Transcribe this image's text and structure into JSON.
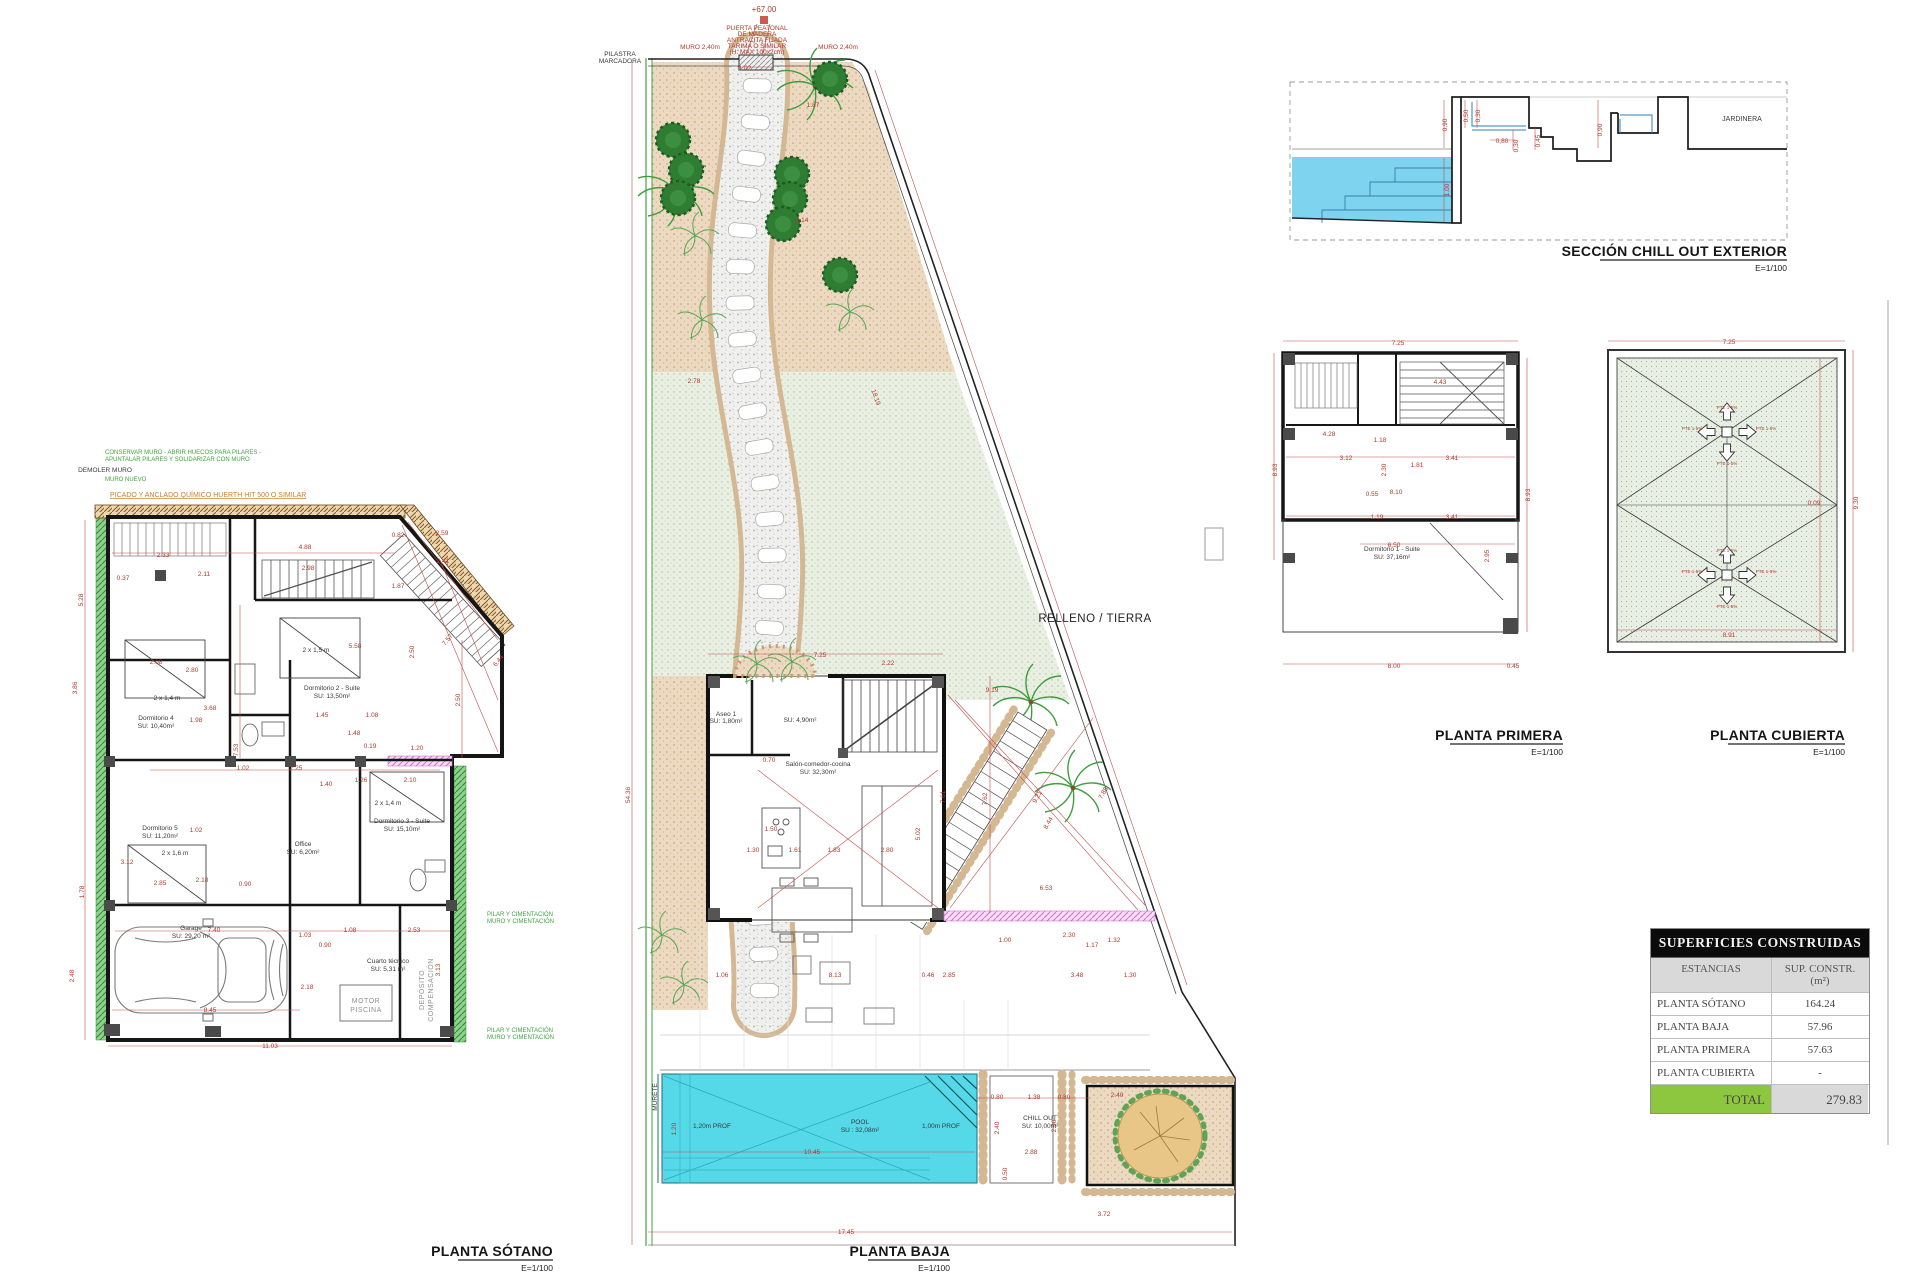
{
  "titles": {
    "sotano": "PLANTA SÓTANO",
    "baja": "PLANTA BAJA",
    "primera": "PLANTA PRIMERA",
    "cubierta": "PLANTA CUBIERTA",
    "seccion": "SECCIÓN CHILL OUT EXTERIOR",
    "scale": "E=1/100"
  },
  "sotano": {
    "annotations": [
      {
        "x": 105,
        "y": 454,
        "t": "CONSERVAR MURO - ABRIR HUECOS PARA PILARES -",
        "c": "g"
      },
      {
        "x": 105,
        "y": 461,
        "t": "APUNTALAR PILARES Y SOLIDARIZAR CON MURO",
        "c": "g"
      },
      {
        "x": 105,
        "y": 472,
        "t": "DEMOLER MURO",
        "c": "k"
      },
      {
        "x": 105,
        "y": 481,
        "t": "MURO NUEVO",
        "c": "g"
      },
      {
        "x": 110,
        "y": 497,
        "t": "PICADO Y ANCLADO QUÍMICO HUERTH HIT 500 O SIMILAR",
        "c": "o"
      },
      {
        "x": 487,
        "y": 916,
        "t": "PILAR Y CIMENTACIÓN",
        "c": "g"
      },
      {
        "x": 487,
        "y": 923,
        "t": "MURO Y CIMENTACIÓN",
        "c": "g"
      },
      {
        "x": 487,
        "y": 1032,
        "t": "PILAR Y CIMENTACIÓN",
        "c": "g"
      },
      {
        "x": 487,
        "y": 1039,
        "t": "MURO Y CIMENTACIÓN",
        "c": "g"
      }
    ],
    "labels": [
      {
        "x": 167,
        "y": 700,
        "t": "2 x 1,4 m"
      },
      {
        "x": 156,
        "y": 720,
        "t": "Dormitorio 4"
      },
      {
        "x": 156,
        "y": 728,
        "t": "SU: 10,40m²"
      },
      {
        "x": 332,
        "y": 690,
        "t": "Dormitorio 2 - Suite"
      },
      {
        "x": 332,
        "y": 698,
        "t": "SU: 13,50m²"
      },
      {
        "x": 316,
        "y": 652,
        "t": "2 x 1,5 m"
      },
      {
        "x": 160,
        "y": 830,
        "t": "Dormitorio 5"
      },
      {
        "x": 160,
        "y": 838,
        "t": "SU: 11,20m²"
      },
      {
        "x": 175,
        "y": 855,
        "t": "2 x 1,6 m"
      },
      {
        "x": 303,
        "y": 846,
        "t": "Office"
      },
      {
        "x": 303,
        "y": 854,
        "t": "SU: 6,20m²"
      },
      {
        "x": 402,
        "y": 823,
        "t": "Dormitorio 3 - Suite"
      },
      {
        "x": 402,
        "y": 831,
        "t": "SU: 15,10m²"
      },
      {
        "x": 388,
        "y": 805,
        "t": "2 x 1,4 m"
      },
      {
        "x": 191,
        "y": 930,
        "t": "Garage"
      },
      {
        "x": 191,
        "y": 938,
        "t": "SU: 29,20 m²"
      },
      {
        "x": 388,
        "y": 963,
        "t": "Cuarto técnico"
      },
      {
        "x": 388,
        "y": 971,
        "t": "SU: 5,31 m²"
      },
      {
        "x": 366,
        "y": 1003,
        "t": "MOTOR",
        "c": "y"
      },
      {
        "x": 366,
        "y": 1012,
        "t": "PISCINA",
        "c": "y"
      },
      {
        "x": 424,
        "y": 990,
        "t": "DEPÓSITO",
        "c": "y",
        "r": -90
      },
      {
        "x": 433,
        "y": 990,
        "t": "COMPENSACIÓN",
        "c": "y",
        "r": -90
      }
    ],
    "dims": [
      {
        "x": 163,
        "y": 557,
        "t": "2.33"
      },
      {
        "x": 123,
        "y": 580,
        "t": "0.37"
      },
      {
        "x": 204,
        "y": 576,
        "t": "2.11"
      },
      {
        "x": 83,
        "y": 600,
        "t": "5.28",
        "r": -90
      },
      {
        "x": 305,
        "y": 549,
        "t": "4.88"
      },
      {
        "x": 308,
        "y": 570,
        "t": "2.98"
      },
      {
        "x": 398,
        "y": 588,
        "t": "1.87"
      },
      {
        "x": 443,
        "y": 563,
        "t": "2.41"
      },
      {
        "x": 449,
        "y": 641,
        "t": "7.57",
        "r": -50
      },
      {
        "x": 414,
        "y": 652,
        "t": "2.50",
        "r": -90
      },
      {
        "x": 355,
        "y": 648,
        "t": "5.58"
      },
      {
        "x": 77,
        "y": 688,
        "t": "3.86",
        "r": -90
      },
      {
        "x": 156,
        "y": 664,
        "t": "2.08"
      },
      {
        "x": 192,
        "y": 672,
        "t": "2.80"
      },
      {
        "x": 210,
        "y": 710,
        "t": "3.68"
      },
      {
        "x": 196,
        "y": 722,
        "t": "1.98"
      },
      {
        "x": 238,
        "y": 750,
        "t": "7.53",
        "r": -90
      },
      {
        "x": 243,
        "y": 770,
        "t": "1.02"
      },
      {
        "x": 296,
        "y": 770,
        "t": "2.25"
      },
      {
        "x": 322,
        "y": 717,
        "t": "1.45"
      },
      {
        "x": 372,
        "y": 717,
        "t": "1.08"
      },
      {
        "x": 354,
        "y": 735,
        "t": "1.48"
      },
      {
        "x": 370,
        "y": 748,
        "t": "0.19"
      },
      {
        "x": 326,
        "y": 786,
        "t": "1.40"
      },
      {
        "x": 361,
        "y": 782,
        "t": "1.26"
      },
      {
        "x": 410,
        "y": 782,
        "t": "2.10"
      },
      {
        "x": 196,
        "y": 832,
        "t": "1.02"
      },
      {
        "x": 127,
        "y": 864,
        "t": "3.12"
      },
      {
        "x": 84,
        "y": 892,
        "t": "1.78",
        "r": -90
      },
      {
        "x": 74,
        "y": 976,
        "t": "2.48",
        "r": -90
      },
      {
        "x": 160,
        "y": 885,
        "t": "2.85"
      },
      {
        "x": 202,
        "y": 882,
        "t": "2.18"
      },
      {
        "x": 245,
        "y": 886,
        "t": "0.90"
      },
      {
        "x": 214,
        "y": 932,
        "t": "7.40"
      },
      {
        "x": 305,
        "y": 937,
        "t": "1.03"
      },
      {
        "x": 350,
        "y": 932,
        "t": "1.08"
      },
      {
        "x": 414,
        "y": 932,
        "t": "2.53"
      },
      {
        "x": 325,
        "y": 947,
        "t": "0.90"
      },
      {
        "x": 307,
        "y": 989,
        "t": "2.18"
      },
      {
        "x": 210,
        "y": 1012,
        "t": "8.45"
      },
      {
        "x": 270,
        "y": 1048,
        "t": "11.03"
      },
      {
        "x": 440,
        "y": 970,
        "t": "3.13",
        "r": -90
      },
      {
        "x": 398,
        "y": 537,
        "t": "0.82"
      },
      {
        "x": 442,
        "y": 535,
        "t": "2.59"
      },
      {
        "x": 500,
        "y": 662,
        "t": "6.44",
        "r": -50
      },
      {
        "x": 417,
        "y": 750,
        "t": "1.20"
      },
      {
        "x": 460,
        "y": 700,
        "t": "2.50",
        "r": -90
      }
    ]
  },
  "baja": {
    "level": "+67.00",
    "relleno": "RELLENO / TIERRA",
    "labels": [
      {
        "x": 757,
        "y": 30,
        "t": "PUERTA PEATONAL",
        "c": "d"
      },
      {
        "x": 757,
        "y": 36,
        "t": "DE MADERA",
        "c": "d"
      },
      {
        "x": 757,
        "y": 42,
        "t": "ANTRACITA FIJADA",
        "c": "d"
      },
      {
        "x": 757,
        "y": 48,
        "t": "TARIMA O SIMILAR",
        "c": "d"
      },
      {
        "x": 757,
        "y": 54,
        "t": "(H. MAX 100x2cm)",
        "c": "d"
      },
      {
        "x": 620,
        "y": 56,
        "t": "PILASTRA"
      },
      {
        "x": 620,
        "y": 63,
        "t": "MARCADORA"
      },
      {
        "x": 726,
        "y": 716,
        "t": "Aseo 1"
      },
      {
        "x": 726,
        "y": 723,
        "t": "SU: 1,80m²"
      },
      {
        "x": 800,
        "y": 722,
        "t": "SU: 4,90m²"
      },
      {
        "x": 818,
        "y": 766,
        "t": "Salón-comedor-cocina"
      },
      {
        "x": 818,
        "y": 774,
        "t": "SU: 32,30m²"
      },
      {
        "x": 712,
        "y": 1128,
        "t": "1,20m PROF"
      },
      {
        "x": 860,
        "y": 1124,
        "t": "POOL"
      },
      {
        "x": 860,
        "y": 1132,
        "t": "SU : 32,08m²"
      },
      {
        "x": 941,
        "y": 1128,
        "t": "1,00m PROF"
      },
      {
        "x": 1040,
        "y": 1120,
        "t": "CHILL OUT"
      },
      {
        "x": 1040,
        "y": 1128,
        "t": "SU: 10,00m²"
      },
      {
        "x": 657,
        "y": 1097,
        "t": "MURETE",
        "r": -90
      }
    ],
    "dims": [
      {
        "x": 745,
        "y": 70,
        "t": "1.02"
      },
      {
        "x": 700,
        "y": 49,
        "t": "MURO 2,40m"
      },
      {
        "x": 838,
        "y": 49,
        "t": "MURO 2,40m"
      },
      {
        "x": 813,
        "y": 107,
        "t": "1.87"
      },
      {
        "x": 802,
        "y": 222,
        "t": "4.14"
      },
      {
        "x": 694,
        "y": 383,
        "t": "2.78"
      },
      {
        "x": 874,
        "y": 398,
        "t": "18.19",
        "r": 70
      },
      {
        "x": 630,
        "y": 795,
        "t": "54.36",
        "r": -90
      },
      {
        "x": 820,
        "y": 657,
        "t": "7.25"
      },
      {
        "x": 888,
        "y": 665,
        "t": "2.22"
      },
      {
        "x": 992,
        "y": 692,
        "t": "9.19"
      },
      {
        "x": 769,
        "y": 762,
        "t": "0.70"
      },
      {
        "x": 771,
        "y": 831,
        "t": "1.50"
      },
      {
        "x": 753,
        "y": 852,
        "t": "1.30"
      },
      {
        "x": 795,
        "y": 852,
        "t": "1.61"
      },
      {
        "x": 834,
        "y": 852,
        "t": "1.83"
      },
      {
        "x": 887,
        "y": 852,
        "t": "2.80"
      },
      {
        "x": 920,
        "y": 834,
        "t": "5.02",
        "r": -90
      },
      {
        "x": 945,
        "y": 797,
        "t": "7.61",
        "r": -90
      },
      {
        "x": 987,
        "y": 799,
        "t": "7.62",
        "r": -90
      },
      {
        "x": 1039,
        "y": 798,
        "t": "9.21",
        "r": -60
      },
      {
        "x": 1050,
        "y": 824,
        "t": "8.44",
        "r": -60
      },
      {
        "x": 1105,
        "y": 794,
        "t": "7.88",
        "r": -60
      },
      {
        "x": 1046,
        "y": 890,
        "t": "6.53"
      },
      {
        "x": 1069,
        "y": 937,
        "t": "2.30"
      },
      {
        "x": 1005,
        "y": 942,
        "t": "1.00"
      },
      {
        "x": 1092,
        "y": 947,
        "t": "1.17"
      },
      {
        "x": 1114,
        "y": 942,
        "t": "1.32"
      },
      {
        "x": 1077,
        "y": 977,
        "t": "3.48"
      },
      {
        "x": 1130,
        "y": 977,
        "t": "1.30"
      },
      {
        "x": 722,
        "y": 977,
        "t": "1.06"
      },
      {
        "x": 835,
        "y": 977,
        "t": "8.13"
      },
      {
        "x": 928,
        "y": 977,
        "t": "0.46"
      },
      {
        "x": 949,
        "y": 977,
        "t": "2.85"
      },
      {
        "x": 676,
        "y": 1129,
        "t": "1.20",
        "r": -90
      },
      {
        "x": 812,
        "y": 1154,
        "t": "10.45"
      },
      {
        "x": 846,
        "y": 1234,
        "t": "17.45"
      },
      {
        "x": 999,
        "y": 1128,
        "t": "2.40",
        "r": -90
      },
      {
        "x": 1031,
        "y": 1154,
        "t": "2.88"
      },
      {
        "x": 1007,
        "y": 1174,
        "t": "0.50",
        "r": -90
      },
      {
        "x": 997,
        "y": 1099,
        "t": "0.80"
      },
      {
        "x": 1034,
        "y": 1099,
        "t": "1.38"
      },
      {
        "x": 1064,
        "y": 1099,
        "t": "0.80"
      },
      {
        "x": 1056,
        "y": 1126,
        "t": "2.60",
        "r": -90
      },
      {
        "x": 1117,
        "y": 1097,
        "t": "2.40"
      },
      {
        "x": 1104,
        "y": 1216,
        "t": "3.72"
      }
    ]
  },
  "primera": {
    "labels": [
      {
        "x": 1392,
        "y": 551,
        "t": "Dormitorio 1 - Suite"
      },
      {
        "x": 1392,
        "y": 559,
        "t": "SU: 37,16m²"
      }
    ],
    "dims": [
      {
        "x": 1398,
        "y": 345,
        "t": "7.25"
      },
      {
        "x": 1440,
        "y": 384,
        "t": "4.43"
      },
      {
        "x": 1329,
        "y": 436,
        "t": "4.28"
      },
      {
        "x": 1346,
        "y": 460,
        "t": "3.12"
      },
      {
        "x": 1452,
        "y": 460,
        "t": "3.41"
      },
      {
        "x": 1380,
        "y": 442,
        "t": "1.18"
      },
      {
        "x": 1386,
        "y": 470,
        "t": "2.30",
        "r": -90
      },
      {
        "x": 1417,
        "y": 467,
        "t": "1.81"
      },
      {
        "x": 1372,
        "y": 496,
        "t": "0.55"
      },
      {
        "x": 1396,
        "y": 494,
        "t": "8.10"
      },
      {
        "x": 1377,
        "y": 519,
        "t": "1.19"
      },
      {
        "x": 1452,
        "y": 519,
        "t": "3.41"
      },
      {
        "x": 1394,
        "y": 547,
        "t": "6.50"
      },
      {
        "x": 1489,
        "y": 556,
        "t": "2.95",
        "r": -90
      },
      {
        "x": 1394,
        "y": 668,
        "t": "8.00"
      },
      {
        "x": 1513,
        "y": 668,
        "t": "0.45"
      },
      {
        "x": 1530,
        "y": 495,
        "t": "8.93",
        "r": -90
      },
      {
        "x": 1277,
        "y": 470,
        "t": "8.93",
        "r": -90
      }
    ]
  },
  "cubierta": {
    "labels": [
      {
        "x": 1727,
        "y": 409,
        "t": "PTE 1-5%",
        "c": "p"
      },
      {
        "x": 1692,
        "y": 430,
        "t": "PTE 1-5%",
        "c": "p"
      },
      {
        "x": 1766,
        "y": 430,
        "t": "PTE 1-5%",
        "c": "p"
      },
      {
        "x": 1727,
        "y": 465,
        "t": "PTE 1-5%",
        "c": "p"
      },
      {
        "x": 1727,
        "y": 552,
        "t": "PTE 1-5%",
        "c": "p"
      },
      {
        "x": 1692,
        "y": 573,
        "t": "PTE 1-5%",
        "c": "p"
      },
      {
        "x": 1766,
        "y": 573,
        "t": "PTE 1-5%",
        "c": "p"
      },
      {
        "x": 1727,
        "y": 608,
        "t": "PTE 1-5%",
        "c": "p"
      }
    ],
    "dims": [
      {
        "x": 1729,
        "y": 344,
        "t": "7.25"
      },
      {
        "x": 1858,
        "y": 503,
        "t": "9.30",
        "r": -90
      },
      {
        "x": 1814,
        "y": 505,
        "t": "0.09"
      },
      {
        "x": 1729,
        "y": 637,
        "t": "8.91"
      }
    ]
  },
  "seccion": {
    "jardinera": "JARDINERA",
    "dims": [
      {
        "x": 1447,
        "y": 125,
        "t": "0,90",
        "r": -90
      },
      {
        "x": 1468,
        "y": 116,
        "t": "0,50",
        "r": -90
      },
      {
        "x": 1480,
        "y": 116,
        "t": "0,30",
        "r": -90
      },
      {
        "x": 1502,
        "y": 143,
        "t": "0,80"
      },
      {
        "x": 1518,
        "y": 146,
        "t": "0,30",
        "r": -90
      },
      {
        "x": 1540,
        "y": 141,
        "t": "0,45",
        "r": -90
      },
      {
        "x": 1449,
        "y": 190,
        "t": "1,00",
        "r": -90
      },
      {
        "x": 1602,
        "y": 130,
        "t": "0,90",
        "r": -90
      }
    ]
  },
  "table": {
    "title": "SUPERFICIES CONSTRUIDAS",
    "col1": "ESTANCIAS",
    "col2": "SUP. CONSTR. (m²)",
    "rows": [
      {
        "name": "PLANTA SÓTANO",
        "value": "164.24"
      },
      {
        "name": "PLANTA BAJA",
        "value": "57.96"
      },
      {
        "name": "PLANTA PRIMERA",
        "value": "57.63"
      },
      {
        "name": "PLANTA CUBIERTA",
        "value": "-"
      }
    ],
    "total_label": "TOTAL",
    "total_value": "279.83"
  }
}
